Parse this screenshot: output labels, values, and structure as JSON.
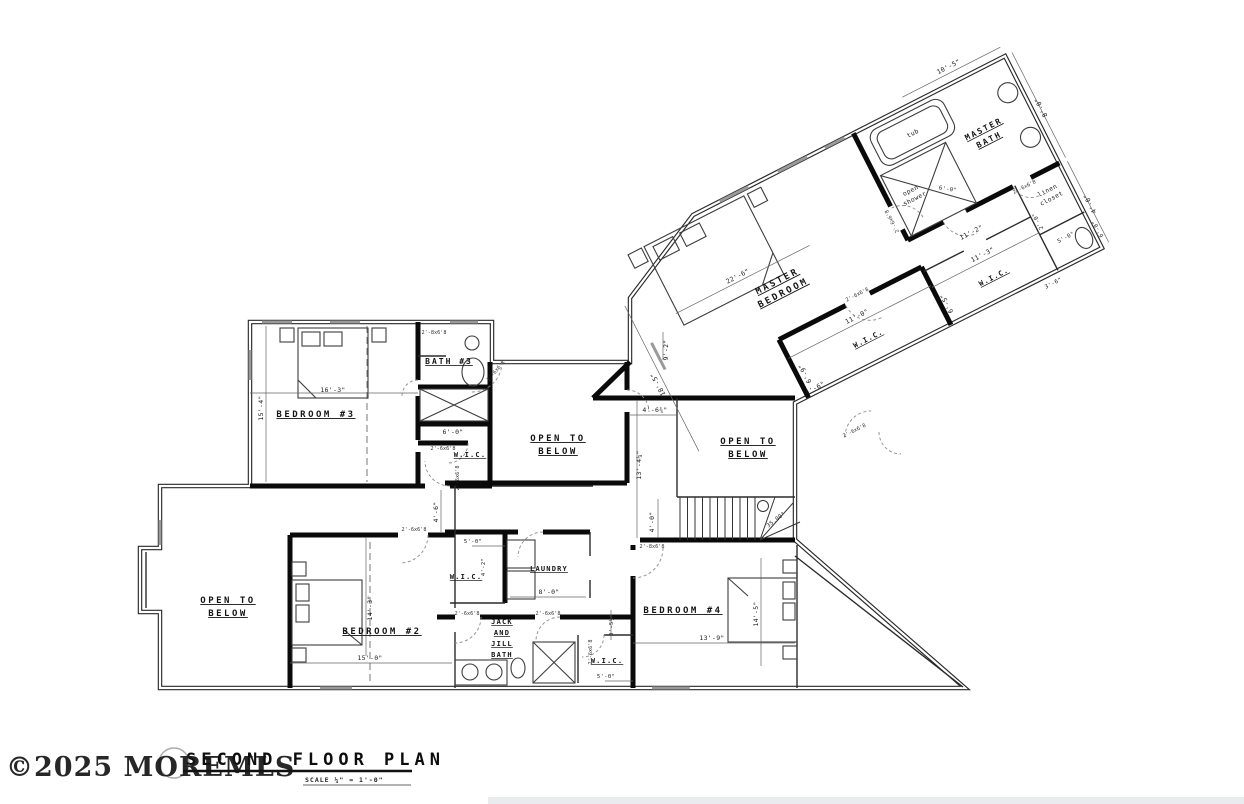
{
  "watermark": {
    "text": "©2025 MOREMLS"
  },
  "title_block": {
    "title": "SECOND FLOOR PLAN",
    "scale": "SCALE ¼\" = 1'-0\""
  },
  "rooms": {
    "master_bedroom": {
      "line1": "MASTER",
      "line2": "BEDROOM"
    },
    "master_bath": {
      "line1": "MASTER",
      "line2": "BATH"
    },
    "bedroom2": {
      "label": "BEDROOM #2"
    },
    "bedroom3": {
      "label": "BEDROOM #3"
    },
    "bedroom4": {
      "label": "BEDROOM #4"
    },
    "bath3": {
      "label": "BATH #3"
    },
    "laundry": {
      "label": "LAUNDRY"
    },
    "jack_jill": {
      "line1": "JACK",
      "line2": "AND",
      "line3": "JILL",
      "line4": "BATH"
    },
    "open_below": {
      "line1": "OPEN TO",
      "line2": "BELOW"
    },
    "wic": {
      "label": "W.I.C."
    },
    "linen": {
      "line1": "linen",
      "line2": "closet"
    }
  },
  "fixtures": {
    "tub": "tub",
    "shower_line1": "open",
    "shower_line2": "shower"
  },
  "stairs": {
    "angle": "35.00°"
  },
  "dims": {
    "d16_3": "16'-3\"",
    "d15_4": "15'-4\"",
    "d6_0": "6'-0\"",
    "d15_0": "15'-0\"",
    "d14_3": "14'-3\"",
    "d4_6": "4'-6\"",
    "d4_6q": "4'-6¾\"",
    "d9_2": "9'-2\"",
    "d13_4q": "13'-4¼\"",
    "d4_0": "4'-0\"",
    "d5_0": "5'-0\"",
    "d4_2": "4'-2\"",
    "d8_0": "8'-0\"",
    "d3_5h": "3'-5½\"",
    "d13_9": "13'-9\"",
    "d14_5": "14'-5\"",
    "d22_6": "22'-6\"",
    "d18_5": "18'-5\"",
    "d10_5": "10'-5\"",
    "d11_0": "11'-0\"",
    "d6_9": "6'-9\"",
    "d11_3": "11'-3\"",
    "d6_5": "6'-5\"",
    "d11_2": "11'-2\"",
    "d2_0": "2'-0\"",
    "d3_6": "3'-6\""
  },
  "door_tags": {
    "t26": "2'-6x6'8",
    "t28": "2'-8x6'8"
  }
}
